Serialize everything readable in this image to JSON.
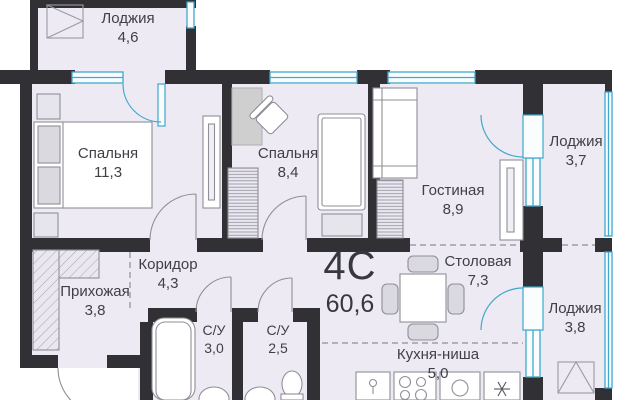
{
  "plan": {
    "type_label": "4С",
    "total_area": "60,6",
    "rooms": [
      {
        "name": "Лоджия",
        "area": "4,6"
      },
      {
        "name": "Спальня",
        "area": "11,3"
      },
      {
        "name": "Спальня",
        "area": "8,4"
      },
      {
        "name": "Гостиная",
        "area": "8,9"
      },
      {
        "name": "Лоджия",
        "area": "3,7"
      },
      {
        "name": "Коридор",
        "area": "4,3"
      },
      {
        "name": "Прихожая",
        "area": "3,8"
      },
      {
        "name": "С/У",
        "area": "3,0"
      },
      {
        "name": "С/У",
        "area": "2,5"
      },
      {
        "name": "Столовая",
        "area": "7,3"
      },
      {
        "name": "Кухня-ниша",
        "area": "5,0"
      },
      {
        "name": "Лоджия",
        "area": "3,8"
      }
    ],
    "colors": {
      "wall": "#313135",
      "floor": "#edeaf3",
      "window": "#3fa8cc",
      "text": "#3f3f46",
      "furniture_stroke": "#8f8f98"
    }
  }
}
